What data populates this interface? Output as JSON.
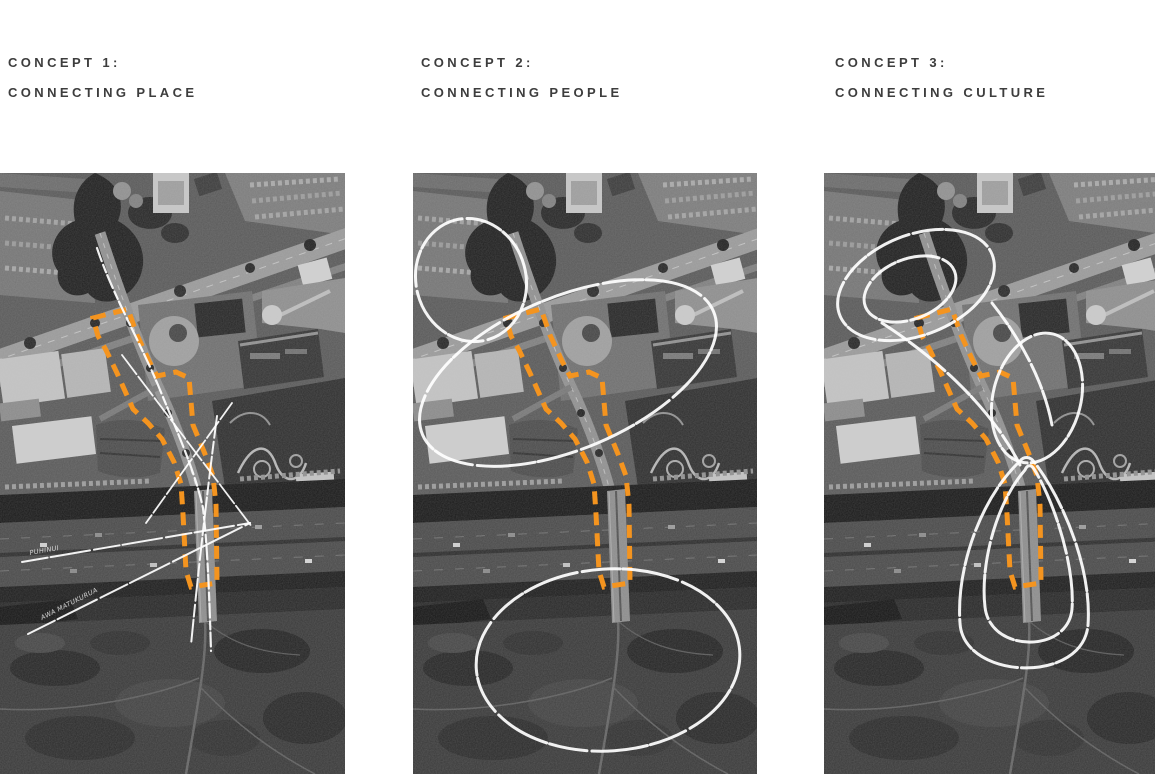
{
  "board": {
    "background": "#FFFFFF",
    "concepts": [
      {
        "number": "CONCEPT 1:",
        "name": "CONNECTING PLACE",
        "annotations": {
          "ray_label_upper": "PUHINUI",
          "ray_label_lower": "AWA MATUKURUA"
        }
      },
      {
        "number": "CONCEPT 2:",
        "name": "CONNECTING PEOPLE"
      },
      {
        "number": "CONCEPT 3:",
        "name": "CONNECTING CULTURE"
      }
    ],
    "legend": {
      "site_boundary_color": "#F4941F",
      "sketch_color": "#FFFFFF",
      "base_map": "grayscale aerial photo: town centre, motorway, riverside park"
    }
  }
}
